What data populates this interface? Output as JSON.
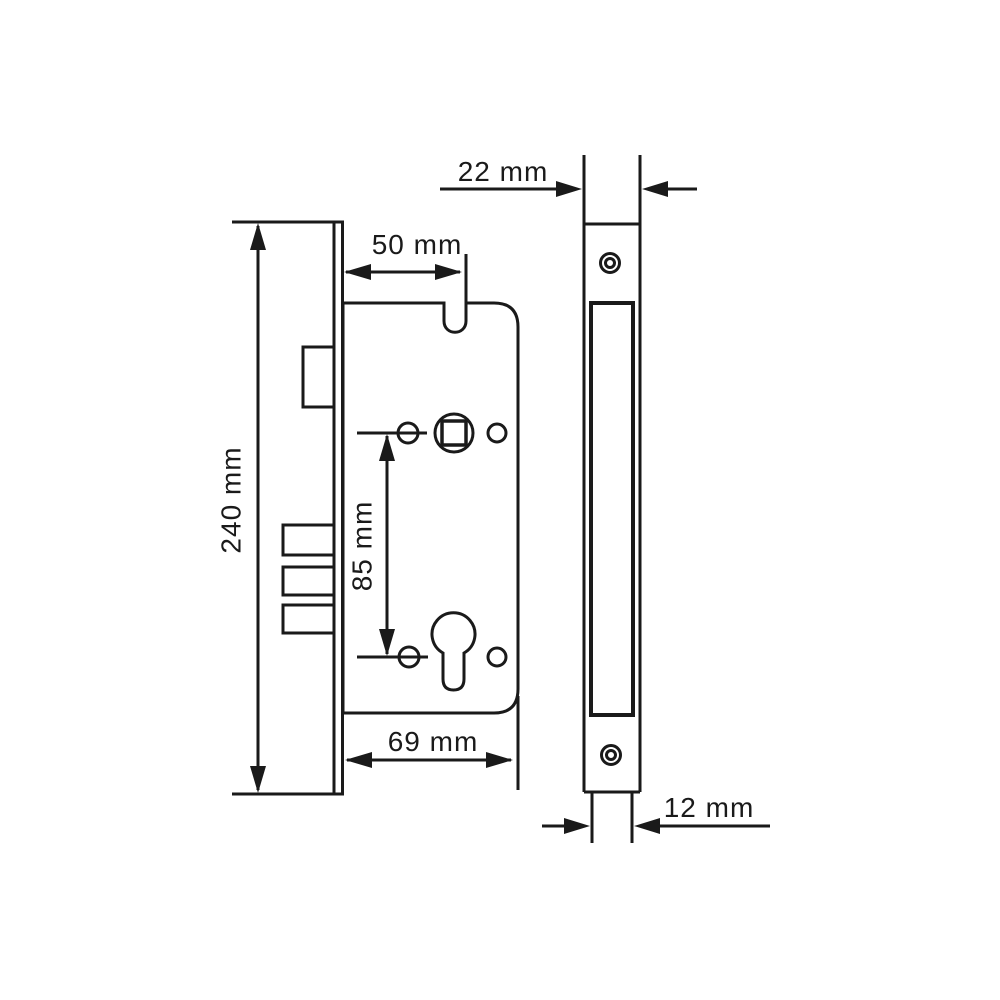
{
  "drawing": {
    "subject": "mortise-lock-technical-drawing",
    "background_color": "#ffffff",
    "line_color": "#1a1a1a",
    "views": {
      "side_view": {
        "name": "lock body side view",
        "dimensions": {
          "total_height": "240 mm",
          "backset": "50 mm",
          "hole_spacing": "85 mm",
          "body_depth": "69 mm"
        }
      },
      "faceplate_view": {
        "name": "faceplate front view",
        "dimensions": {
          "faceplate_width": "22 mm",
          "case_thickness": "12 mm"
        }
      }
    }
  }
}
